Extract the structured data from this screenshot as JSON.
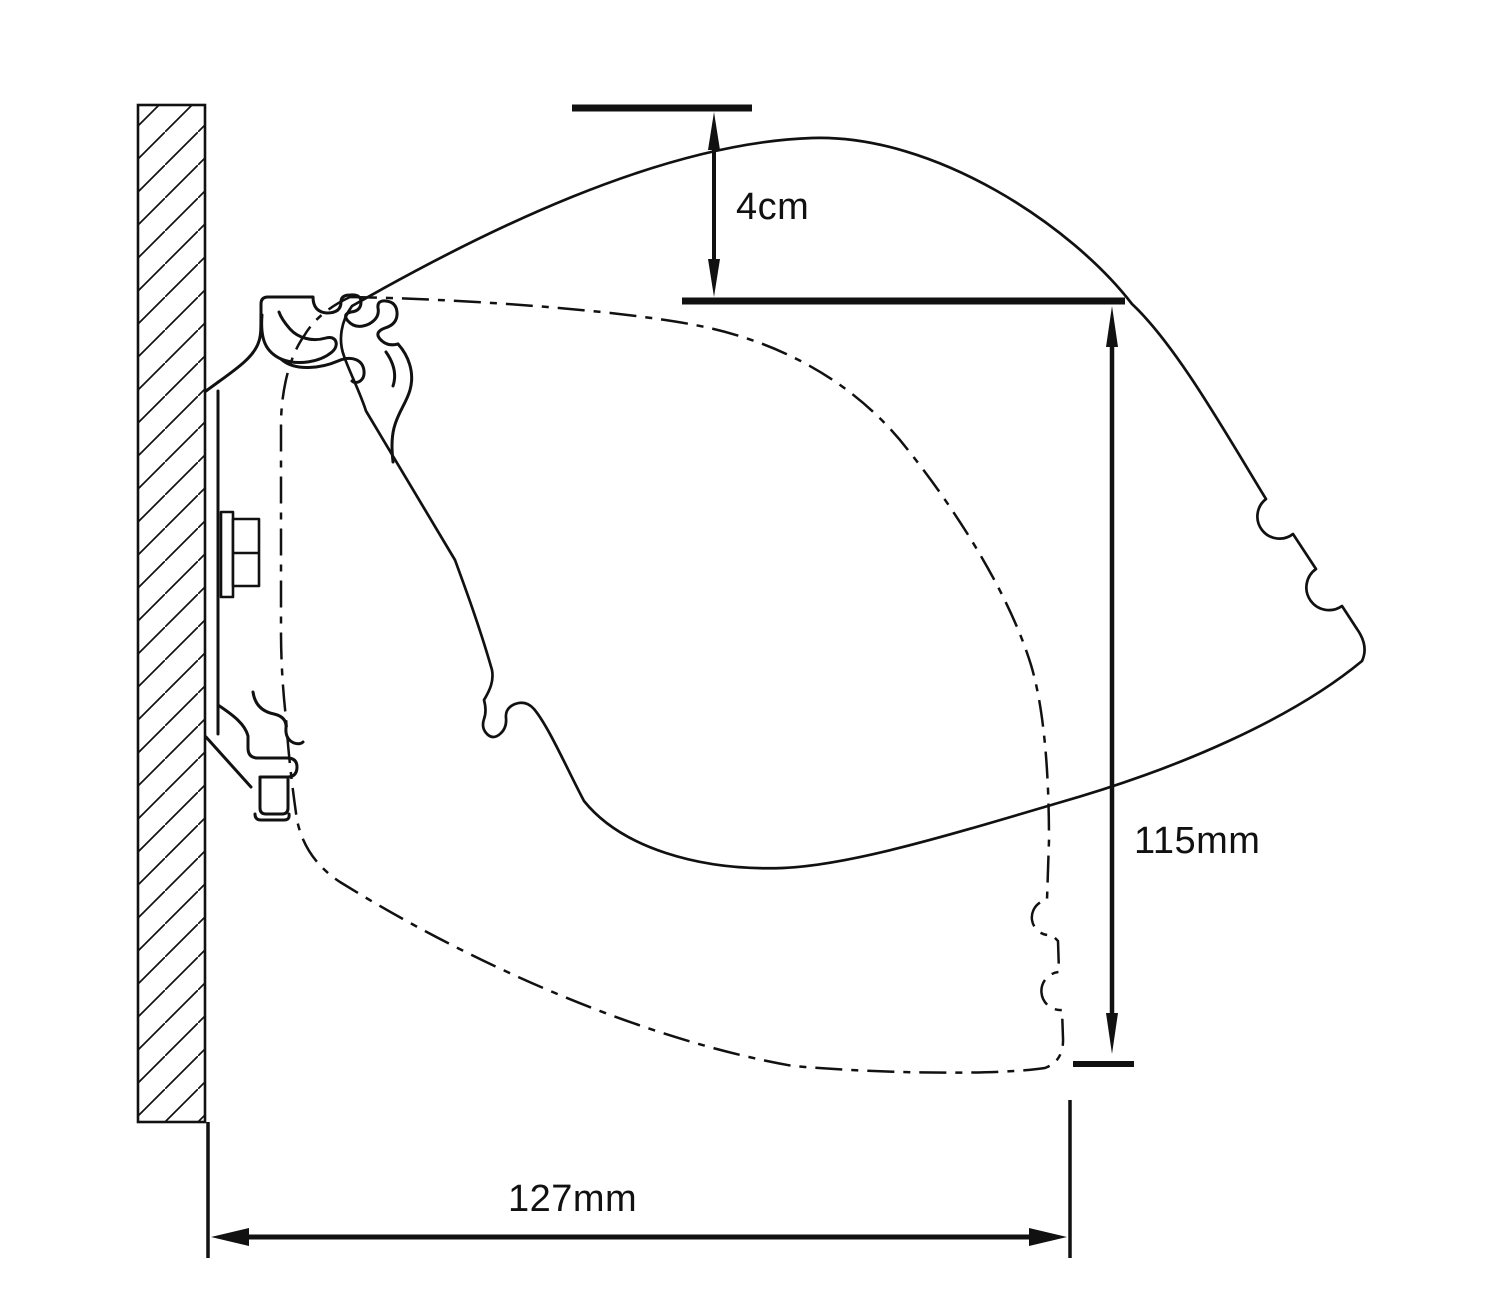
{
  "diagram": {
    "background_color": "#ffffff",
    "line_color": "#111111",
    "dimensions": {
      "vertical_offset": {
        "label": "4cm"
      },
      "height": {
        "label": "115mm"
      },
      "depth": {
        "label": "127mm"
      }
    }
  }
}
